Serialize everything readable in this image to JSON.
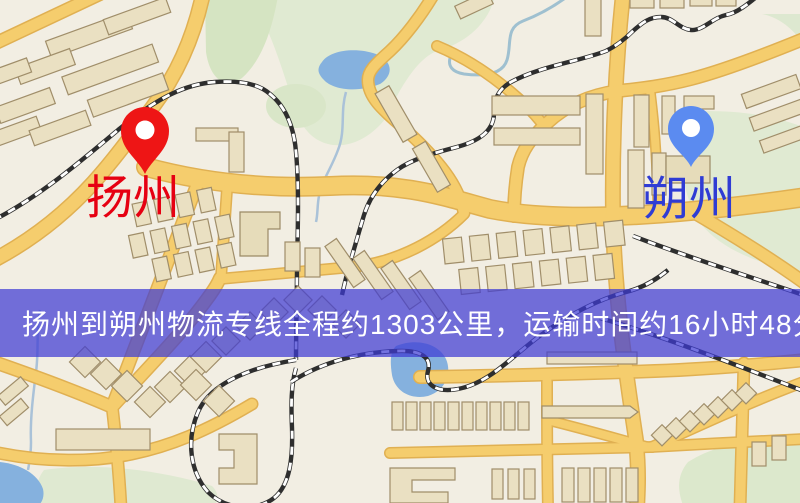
{
  "map": {
    "origin": {
      "name": "扬州",
      "pin_color": "#ee1515",
      "label_color": "#e60012"
    },
    "destination": {
      "name": "朔州",
      "pin_color": "#5b8bf0",
      "label_color": "#2f3cd4"
    },
    "banner": {
      "text": "扬州到朔州物流专线全程约1303公里，运输时间约16小时48分钟.",
      "background": "rgba(62,59,212,0.72)",
      "text_color": "#ffffff"
    },
    "palette": {
      "background": "#f2eee3",
      "road_fill": "#f5cd6d",
      "road_casing": "#e0b052",
      "building_fill": "#eae0c2",
      "building_stroke": "#a08e6a",
      "green_area": "#e0ead2",
      "water": "#85b1de",
      "railway_dark": "#2e2e2e",
      "railway_light": "#ffffff"
    }
  }
}
